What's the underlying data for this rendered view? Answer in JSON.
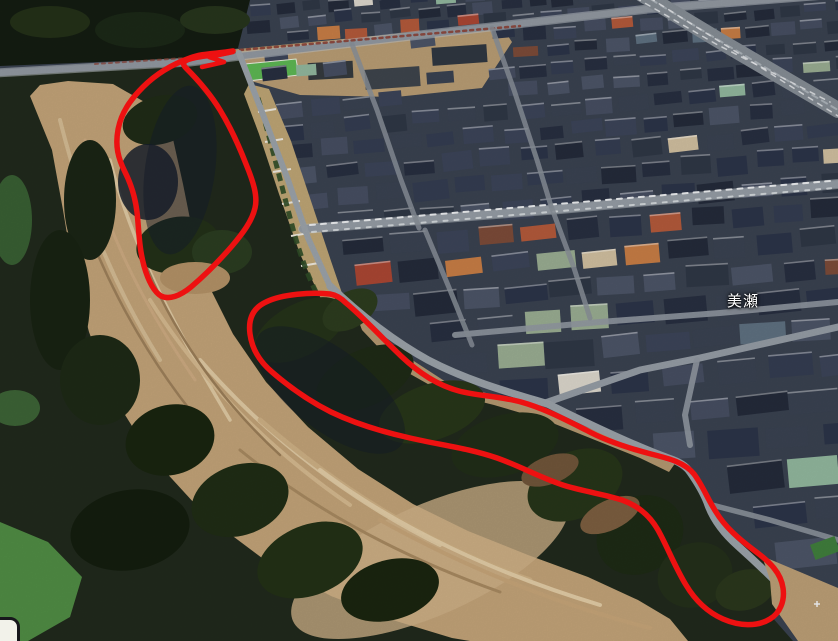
{
  "app": {
    "name": "aerial-3d-map-view"
  },
  "map": {
    "place_label": {
      "text": "美瀬",
      "color": "#ffffff"
    },
    "partial_ui_card": {
      "visible": true
    }
  },
  "annotations": {
    "color": "#ed1111",
    "stroke_width": 5.5,
    "outlines": [
      {
        "id": "upper-slope-outline",
        "path": "M233,51 C216,54 203,53 190,58 C173,64 156,74 143,87 C130,100 121,113 118,130 C115,146 118,158 125,172 C131,184 135,196 137,212 C139,230 139,248 144,266 C148,280 153,291 161,296 C169,300 180,296 191,287 C204,276 219,261 232,246 C243,233 252,221 255,208 C258,196 253,181 246,164 C239,146 231,128 220,110 C209,92 196,78 186,68 C182,64 183,61 190,59 C202,55 218,56 233,51 Z"
      },
      {
        "id": "lower-slope-outline",
        "path": "M330,294 C312,292 282,294 266,302 C253,308 248,319 250,334 C252,349 259,361 272,372 C287,385 307,400 331,412 C356,424 383,432 410,438 C440,445 468,448 497,458 C520,466 543,479 566,486 C587,492 607,495 622,500 C639,506 650,516 658,530 C667,546 675,567 686,585 C695,600 707,612 723,619 C739,626 757,627 770,619 C780,613 785,601 783,588 C781,573 770,562 755,551 C739,539 725,527 716,512 C707,498 703,486 694,474 C685,463 671,459 651,454 C628,448 606,441 586,430 C564,419 543,408 521,402 C499,396 478,396 459,391 C437,385 419,373 401,356 C381,337 362,316 346,303 C341,298 336,295 330,294 Z"
      },
      {
        "id": "outline-tip-scribble",
        "path": "M233,52 L209,57 L224,62 L202,67"
      }
    ]
  },
  "scene": {
    "seed": 7,
    "palette": {
      "residential_base": "#39414f",
      "roof_dark": [
        "#2b3347",
        "#333c50",
        "#3b4357",
        "#272e3f",
        "#454d60",
        "#394150",
        "#2e3644",
        "#4b5365",
        "#232a39"
      ],
      "roof_accent": [
        "#b0583a",
        "#c47b44",
        "#7a4a38",
        "#97aa8f",
        "#8fb49b",
        "#cdbc9d",
        "#d8d3c8",
        "#5d6f7e",
        "#a84532"
      ],
      "road": "#8f969e",
      "road_edge": "#c2c7cc",
      "forest_dark": "#1c2617",
      "forest_mid": "#27351e",
      "forest_shadow": "#161e2b",
      "bare_earth": "#bfa076",
      "bare_earth_light": "#d8c19c",
      "bare_earth_dark": "#9c7f5c",
      "field_green": "#5cb452",
      "grass_green": "#4f8a43"
    }
  }
}
